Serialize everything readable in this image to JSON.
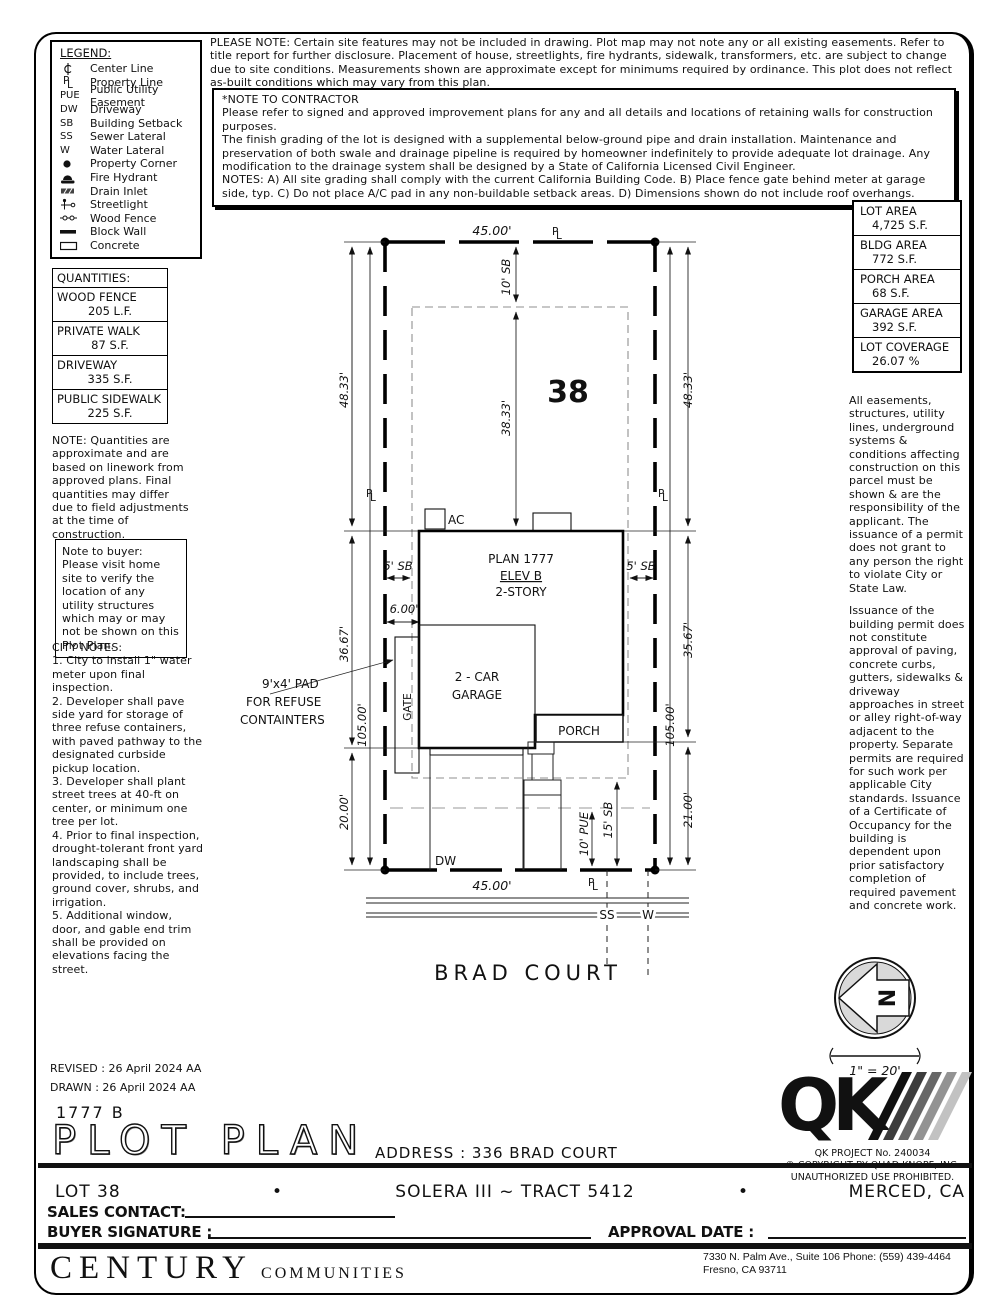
{
  "legend": {
    "title": "LEGEND:",
    "items": [
      {
        "icon": "center-line-icon",
        "label": "Center Line"
      },
      {
        "icon": "property-line-icon",
        "label": "Property Line"
      },
      {
        "symbol": "PUE",
        "label": "Public Utility Easement"
      },
      {
        "symbol": "DW",
        "label": "Driveway"
      },
      {
        "symbol": "SB",
        "label": "Building Setback"
      },
      {
        "symbol": "SS",
        "label": "Sewer Lateral"
      },
      {
        "symbol": "W",
        "label": "Water Lateral"
      },
      {
        "icon": "property-corner-icon",
        "label": "Property Corner"
      },
      {
        "icon": "fire-hydrant-icon",
        "label": "Fire Hydrant"
      },
      {
        "icon": "drain-inlet-icon",
        "label": "Drain Inlet"
      },
      {
        "icon": "streetlight-icon",
        "label": "Streetlight"
      },
      {
        "icon": "wood-fence-icon",
        "label": "Wood Fence"
      },
      {
        "icon": "block-wall-icon",
        "label": "Block Wall"
      },
      {
        "icon": "concrete-icon",
        "label": "Concrete"
      }
    ]
  },
  "top_note": "PLEASE NOTE:  Certain site features may not be included in drawing.  Plot map may not note any or all existing easements. Refer to title report for further disclosure.  Placement of house, streetlights, fire hydrants, sidewalk, transformers, etc. are subject to change due to site conditions.  Measurements shown are approximate except for minimums required by ordinance.  This plot does not reflect as-built conditions which may vary from this plan.",
  "contractor_note": "*NOTE TO CONTRACTOR\nPlease refer to signed and approved improvement plans for any and all details and locations of retaining walls for construction purposes.\nThe finish grading of the lot is designed with a supplemental below-ground pipe and drain installation.  Maintenance and preservation of both swale and drainage pipeline is required by homeowner indefinitely to provide adequate lot drainage.  Any modification to the drainage system shall be designed by a State of California Licensed Civil Engineer.\nNOTES:  A) All site grading shall comply with the current California Building Code.  B) Place fence gate behind meter at garage side, typ.  C) Do not place A/C pad in any non-buildable setback areas.  D) Dimensions shown do not include roof overhangs.",
  "areas": {
    "rows": [
      {
        "label": "LOT AREA",
        "value": "4,725 S.F."
      },
      {
        "label": "BLDG AREA",
        "value": "772 S.F."
      },
      {
        "label": "PORCH AREA",
        "value": "68 S.F."
      },
      {
        "label": "GARAGE AREA",
        "value": "392 S.F."
      },
      {
        "label": "LOT COVERAGE",
        "value": "26.07 %"
      }
    ]
  },
  "quantities": {
    "title": "QUANTITIES:",
    "rows": [
      {
        "label": "WOOD FENCE",
        "value": "205 L.F."
      },
      {
        "label": "PRIVATE WALK",
        "value": "87 S.F."
      },
      {
        "label": "DRIVEWAY",
        "value": "335 S.F."
      },
      {
        "label": "PUBLIC SIDEWALK",
        "value": "225 S.F."
      }
    ],
    "note": "NOTE: Quantities are approximate and are based on linework from approved plans.  Final quantities may differ due to field adjustments at the time of construction."
  },
  "buyer_note": "Note to buyer: Please visit home site to verify the location of any utility structures which may or may not be shown on this Plot Plan.",
  "city_notes": "CITY NOTES:\n1. City to install 1\" water meter upon final inspection.\n2. Developer shall pave side yard for storage of three refuse containers, with paved pathway to the designated curbside pickup location.\n3. Developer shall plant street trees at 40-ft on center, or minimum one tree per lot.\n4. Prior to final inspection, drought-tolerant front yard landscaping shall be provided, to include trees, ground cover, shrubs, and irrigation.\n5. Additional window, door, and gable end trim shall be provided on elevations facing the street.",
  "right_notes": {
    "p1": "All easements, structures, utility lines, underground systems & conditions affecting construction on this parcel must be shown & are the responsibility of the applicant. The issuance of a permit does not grant to any person the right to violate City or State Law.",
    "p2": "Issuance of the building permit does not constitute approval of paving, concrete curbs, gutters, sidewalks & driveway approaches in street or alley right-of-way adjacent to the property. Separate permits are required for such work per applicable City standards. Issuance of a Certificate of Occupancy for the building is dependent upon prior satisfactory completion of required pavement and concrete work."
  },
  "plot": {
    "lot_number": "38",
    "top_dim": "45.00'",
    "bottom_dim": "45.00'",
    "dim4833": "48.33'",
    "dim3833": "38.33'",
    "dim3667": "36.67'",
    "dim3567": "35.67'",
    "dim105": "105.00'",
    "dim2000": "20.00'",
    "dim2100": "21.00'",
    "dim600": "6.00'",
    "sb10": "10' SB",
    "sb5": "5' SB",
    "sb15": "15' SB",
    "pue10": "10' PUE",
    "ac": "AC",
    "plan1": "PLAN 1777",
    "plan2": "ELEV B",
    "plan3": "2-STORY",
    "garage1": "2 - CAR",
    "garage2": "GARAGE",
    "gate": "GATE",
    "porch": "PORCH",
    "refuse1": "9'x4' PAD",
    "refuse2": "FOR REFUSE",
    "refuse3": "CONTAINTERS",
    "dw": "DW",
    "ss": "SS",
    "w": "W",
    "street": "BRAD COURT",
    "sym": {
      "p": "P",
      "l": "L"
    }
  },
  "compass": {
    "n": "N",
    "scale": "1\" = 20'"
  },
  "qk": {
    "logo": "QK",
    "project": "QK PROJECT No. 240034",
    "copyright": "©   COPYRIGHT BY QUAD KNOPF, INC.",
    "unauthorized": "UNAUTHORIZED USE PROHIBITED."
  },
  "titleblock": {
    "revised": "REVISED : 26 April 2024  AA",
    "drawn": "DRAWN :  26 April 2024  AA",
    "plan_code": "1777   B",
    "title": "PLOT PLAN",
    "address_line": "ADDRESS :   336 BRAD COURT",
    "lot": "LOT 38",
    "bullet": "•",
    "tract": "SOLERA III ~ TRACT 5412",
    "city": "MERCED, CA",
    "sales_label": "SALES CONTACT:",
    "buyer_label": "BUYER SIGNATURE :",
    "approval_label": "APPROVAL DATE :"
  },
  "footer": {
    "brand1": "CENTURY",
    "brand2": "COMMUNITIES",
    "addr1": "7330 N. Palm Ave., Suite 106    Phone:  (559) 439-4464",
    "addr2": "Fresno, CA  93711"
  }
}
